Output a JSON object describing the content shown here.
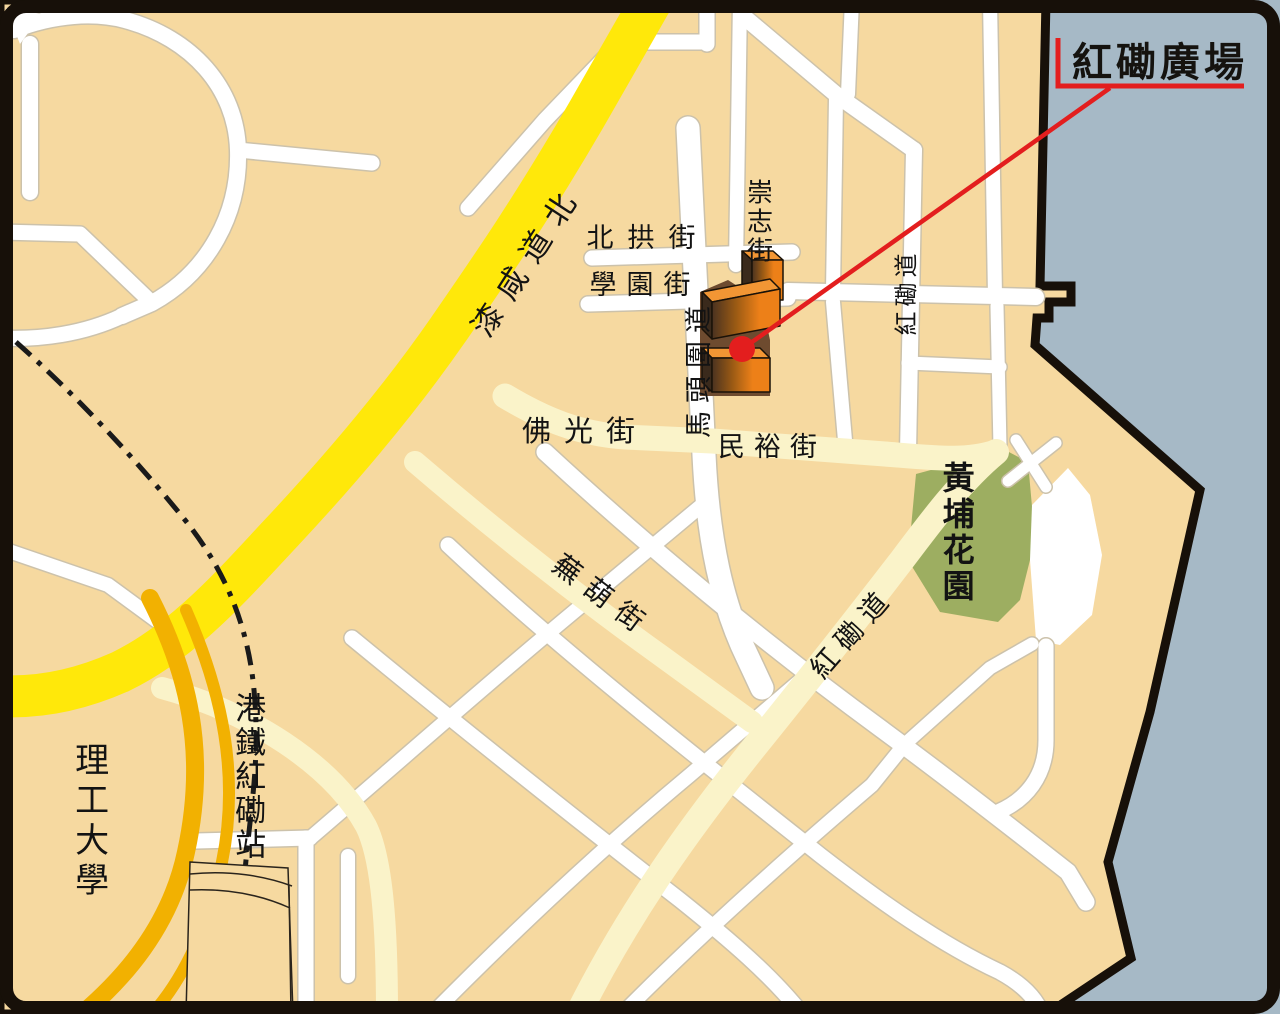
{
  "title": {
    "text": "紅磡廣場"
  },
  "labels": {
    "streets": {
      "pak_kung": "北拱街",
      "hok_yuen": "學園街",
      "sung_chi": "崇志街",
      "ma_tau_wai": "馬頭圍道",
      "hung_hom_road_north": "紅磡道",
      "fat_kwong": "佛光街",
      "man_yue": "民裕街",
      "wu_wu": "蕪葫街",
      "hung_hom_road_diag": "紅磡道",
      "chatham_road_north": "漆咸道北"
    },
    "places": {
      "whampoa_garden": "黃埔花園",
      "mtr_hung_hom_station": "港鐵紅磡站",
      "polytechnic_university": "理工大學"
    }
  },
  "colors": {
    "land": "#F6D9A0",
    "water": "#A6B9C6",
    "road_white": "#FFFFFF",
    "road_casing": "#CCC2AB",
    "road_cream": "#FAF3C9",
    "road_yellow": "#FFE80A",
    "road_gold": "#F2B101",
    "park_green": "#9DAE61",
    "building_orange": "#ED8018",
    "accent_red": "#E31E1E",
    "outline_black": "#171009"
  }
}
